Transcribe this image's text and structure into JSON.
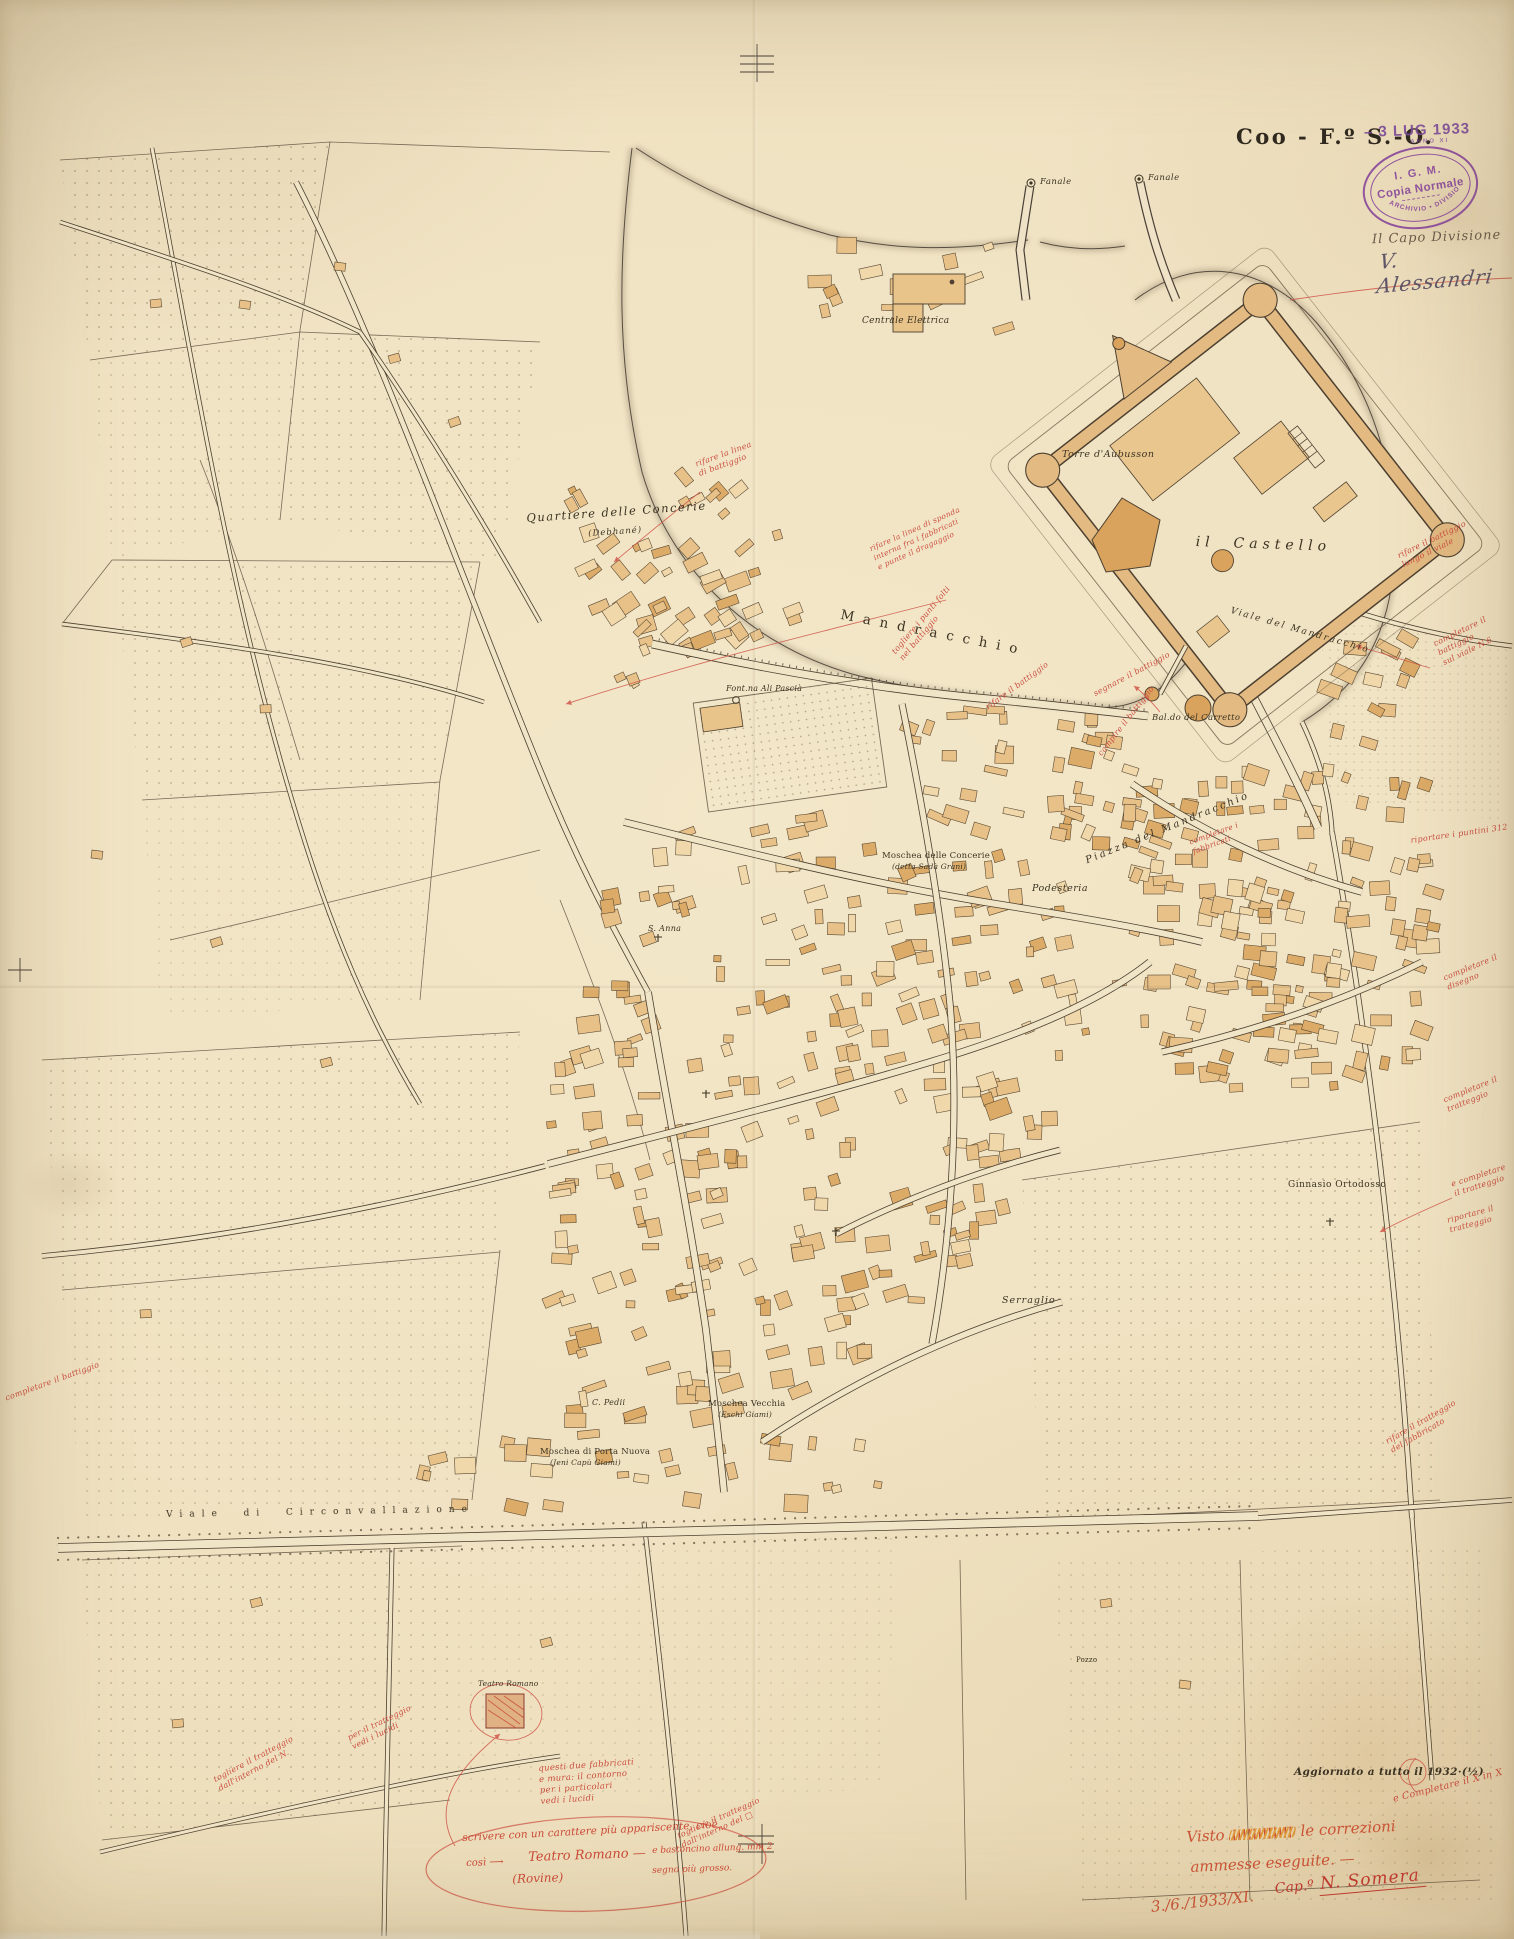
{
  "palette": {
    "paper": "#efe1c0",
    "ink": "#453a2b",
    "building_tan": "#e7c188",
    "building_light": "#f0d8ab",
    "building_orange": "#dcab67",
    "accent_orange": "#d99f58",
    "annotation_red": "#cb4e40",
    "handwriting_orange_red": "#cc5436",
    "stamp_purple": "#7c4a9a"
  },
  "header": {
    "sheet_title": "Coo - F.º S.-O.",
    "date_stamp": "– 3 LUG 1933",
    "date_stamp_sub": "ANNO XI",
    "igm_line1": "I. G. M.",
    "igm_line2": "Copia Normale",
    "igm_ring": "ARCHIVIO • DIVISIONE",
    "capo_label": "Il Capo Divisione",
    "capo_signature": "V. Alessandri"
  },
  "footer": {
    "updated_note": "Aggiornato a tutto il 1932·(½)",
    "visto_pre": "Visto",
    "visto_post": "le correzioni",
    "visto_line2": "ammesse eseguite. —",
    "visto_date": "3./6./1933/XI.",
    "visto_sig_pre": "Cap.º",
    "visto_sig_name": "N. Somera"
  },
  "map_labels": [
    {
      "t": "Fanale",
      "x": 1040,
      "y": 178,
      "s": 8.5,
      "r": 0,
      "sp": 0.5,
      "it": true
    },
    {
      "t": "Fanale",
      "x": 1148,
      "y": 174,
      "s": 8.5,
      "r": 0,
      "sp": 0.5,
      "it": true
    },
    {
      "t": "Centrale Elettrica",
      "x": 862,
      "y": 316,
      "s": 9,
      "r": 0,
      "sp": 0.3,
      "it": true
    },
    {
      "t": "Quartiere delle Concerie",
      "x": 526,
      "y": 512,
      "s": 11.5,
      "r": -4,
      "sp": 1.5,
      "it": true
    },
    {
      "t": "(Debhané)",
      "x": 588,
      "y": 530,
      "s": 8.5,
      "r": -4,
      "sp": 1,
      "it": true
    },
    {
      "t": "Torre d'Aubusson",
      "x": 1062,
      "y": 450,
      "s": 9.5,
      "r": 0,
      "sp": 0.5,
      "it": true
    },
    {
      "t": "il  Castello",
      "x": 1196,
      "y": 534,
      "s": 14,
      "r": 2,
      "sp": 5,
      "it": true
    },
    {
      "t": "Mandracchio",
      "x": 842,
      "y": 608,
      "s": 13.5,
      "r": 11,
      "sp": 9,
      "it": false
    },
    {
      "t": "Bal.do del Carretto",
      "x": 1152,
      "y": 714,
      "s": 8.5,
      "r": 0,
      "sp": 0.3,
      "it": true
    },
    {
      "t": "Font.na Ali Pascià",
      "x": 726,
      "y": 684,
      "s": 8,
      "r": 0,
      "sp": 0.2,
      "it": true
    },
    {
      "t": "Moschea delle Concerie",
      "x": 882,
      "y": 852,
      "s": 8.5,
      "r": 0,
      "sp": 0.2,
      "it": false
    },
    {
      "t": "(detta Sadà Grani)",
      "x": 892,
      "y": 863,
      "s": 7.5,
      "r": 0,
      "sp": 0.2,
      "it": true
    },
    {
      "t": "Podesteria",
      "x": 1032,
      "y": 884,
      "s": 9.5,
      "r": 0,
      "sp": 0.5,
      "it": true
    },
    {
      "t": "Piazza del Mandracchio",
      "x": 1084,
      "y": 856,
      "s": 10,
      "r": -22,
      "sp": 2.5,
      "it": true
    },
    {
      "t": "Viale del Mandracchio",
      "x": 1232,
      "y": 606,
      "s": 9,
      "r": 16,
      "sp": 2,
      "it": true
    },
    {
      "t": "S. Anna",
      "x": 648,
      "y": 924,
      "s": 8,
      "r": 0,
      "sp": 0.3,
      "it": true
    },
    {
      "t": "Ginnasio Ortodosso",
      "x": 1288,
      "y": 1180,
      "s": 9,
      "r": 0,
      "sp": 0.5,
      "it": false
    },
    {
      "t": "Serraglio",
      "x": 1002,
      "y": 1296,
      "s": 9.5,
      "r": 0,
      "sp": 1,
      "it": true
    },
    {
      "t": "C. Pedii",
      "x": 592,
      "y": 1398,
      "s": 8,
      "r": 0,
      "sp": 0.3,
      "it": true
    },
    {
      "t": "Moschea Vecchia",
      "x": 708,
      "y": 1400,
      "s": 8.5,
      "r": 0,
      "sp": 0.2,
      "it": false
    },
    {
      "t": "(Eschi Giami)",
      "x": 718,
      "y": 1411,
      "s": 7.5,
      "r": 0,
      "sp": 0.2,
      "it": true
    },
    {
      "t": "Moschea di Porta Nuova",
      "x": 540,
      "y": 1448,
      "s": 8.5,
      "r": 0,
      "sp": 0.2,
      "it": false
    },
    {
      "t": "(Jeni Capù Giami)",
      "x": 550,
      "y": 1459,
      "s": 7.5,
      "r": 0,
      "sp": 0.2,
      "it": true
    },
    {
      "t": "Teatro Romano",
      "x": 478,
      "y": 1680,
      "s": 7.5,
      "r": 0,
      "sp": 0.2,
      "it": true
    },
    {
      "t": "Pozzo",
      "x": 1076,
      "y": 1656,
      "s": 7,
      "r": 0,
      "sp": 0.2,
      "it": false
    },
    {
      "t": "Viale  di  Circonvallazione",
      "x": 166,
      "y": 1510,
      "s": 9,
      "r": -1,
      "sp": 7,
      "it": false
    }
  ],
  "red_notes": [
    {
      "t": "rifare la linea\ndi battiggio",
      "x": 694,
      "y": 460,
      "r": -20,
      "s": 8
    },
    {
      "t": "rifare la linea di sponda\ninterna fra i fabbricati\ne punte il dragaggio",
      "x": 868,
      "y": 545,
      "r": -24,
      "s": 7.5
    },
    {
      "t": "rifare il battiggio",
      "x": 984,
      "y": 704,
      "r": -36,
      "s": 8
    },
    {
      "t": "segnare il battiggio",
      "x": 1092,
      "y": 690,
      "r": -28,
      "s": 8
    },
    {
      "t": "togliere i punti folti\nnel battiggio",
      "x": 890,
      "y": 650,
      "r": -50,
      "s": 8
    },
    {
      "t": "campire il battiggio",
      "x": 1096,
      "y": 752,
      "r": -52,
      "s": 8
    },
    {
      "t": "rifare il battiggio\nlungo il viale",
      "x": 1396,
      "y": 552,
      "r": -26,
      "s": 8
    },
    {
      "t": "completare il battiggio\nsul viale N.6",
      "x": 1432,
      "y": 640,
      "r": -26,
      "s": 8
    },
    {
      "t": "riportare i puntini 312",
      "x": 1410,
      "y": 836,
      "r": -8,
      "s": 8
    },
    {
      "t": "completare i\nfabbricati",
      "x": 1188,
      "y": 838,
      "r": -20,
      "s": 7.5
    },
    {
      "t": "completare il\ndisegno",
      "x": 1442,
      "y": 974,
      "r": -22,
      "s": 8
    },
    {
      "t": "completare il\ntratteggio",
      "x": 1442,
      "y": 1096,
      "r": -22,
      "s": 8
    },
    {
      "t": "e completare\nil tratteggio",
      "x": 1450,
      "y": 1180,
      "r": -18,
      "s": 8
    },
    {
      "t": "riportare il\ntratteggio",
      "x": 1446,
      "y": 1216,
      "r": -15,
      "s": 8
    },
    {
      "t": "rifare il tratteggio\ndel fabbricato",
      "x": 1384,
      "y": 1438,
      "r": -30,
      "s": 8
    },
    {
      "t": "completare il battiggio",
      "x": 4,
      "y": 1394,
      "r": -20,
      "s": 8
    },
    {
      "t": "togliere il tratteggio\ndall'interno del N.",
      "x": 212,
      "y": 1776,
      "r": -28,
      "s": 8
    },
    {
      "t": "per il tratteggio\nvedi i lucidi",
      "x": 346,
      "y": 1734,
      "r": -26,
      "s": 8
    },
    {
      "t": "togliere il tratteggio\ndall'interno del □",
      "x": 676,
      "y": 1832,
      "r": -24,
      "s": 8
    },
    {
      "t": "e Completare il X in X",
      "x": 1392,
      "y": 1794,
      "r": -14,
      "s": 9.5
    },
    {
      "t": "questi due fabbricati\ne mura: il contorno\nper i particolari\nvedi i lucidi",
      "x": 538,
      "y": 1764,
      "r": -4,
      "s": 8.5
    }
  ],
  "oval_note": {
    "parts": [
      {
        "t": "scrivere con un carattere più appariscente, cioè",
        "x": 462,
        "y": 1832,
        "s": 10.5,
        "r": -3
      },
      {
        "t": "così ⟶",
        "x": 466,
        "y": 1858,
        "s": 10,
        "r": -2
      },
      {
        "t": "Teatro Romano —",
        "x": 528,
        "y": 1850,
        "s": 13,
        "r": -2
      },
      {
        "t": "e bastoncino allung. mm 2",
        "x": 652,
        "y": 1846,
        "s": 9,
        "r": -2
      },
      {
        "t": "(Rovine)",
        "x": 512,
        "y": 1872,
        "s": 12,
        "r": -2
      },
      {
        "t": "segno più grosso.",
        "x": 652,
        "y": 1866,
        "s": 9,
        "r": -2
      }
    ]
  }
}
